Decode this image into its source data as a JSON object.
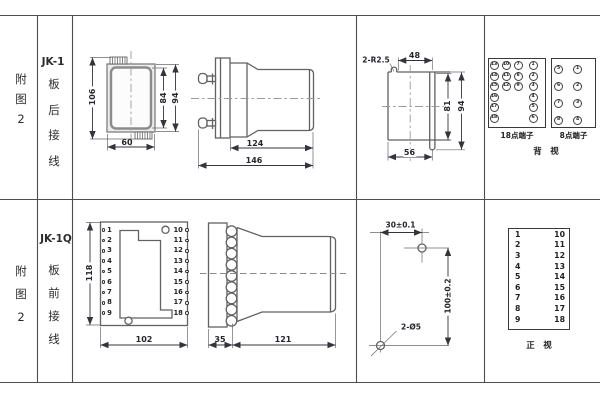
{
  "row1": {
    "fig_label": [
      "附",
      "图",
      "2"
    ],
    "model": "JK-1",
    "mount_label": [
      "板",
      "后",
      "接",
      "线"
    ],
    "rear": {
      "dim_total_h": "106",
      "dim_inner_h": "84",
      "dim_outer_h": "94",
      "dim_width": "60"
    },
    "side": {
      "dim_body": "124",
      "dim_total": "146"
    },
    "cutout": {
      "note_radius": "2-R2.5",
      "dim_top_w": "48",
      "dim_inner_h": "81",
      "dim_outer_h": "94",
      "dim_bottom_w": "56"
    },
    "t18": {
      "caption": "18点端子",
      "col1": [
        "13",
        "14",
        "15",
        "16",
        "17",
        "18"
      ],
      "col2": [
        "10",
        "11",
        "12"
      ],
      "col3": [
        "7",
        "8",
        "9"
      ],
      "col4": [
        "1",
        "2",
        "3",
        "4",
        "5",
        "6"
      ]
    },
    "t8": {
      "caption": "8点端子",
      "col1": [
        "5",
        "6",
        "7",
        "8"
      ],
      "col2": [
        "1",
        "2",
        "3",
        "4"
      ]
    },
    "view_label": "背　视"
  },
  "row2": {
    "fig_label": [
      "附",
      "图",
      "2"
    ],
    "model": "JK-1Q",
    "mount_label": [
      "板",
      "前",
      "接",
      "线"
    ],
    "front": {
      "dim_h": "118",
      "dim_w": "102",
      "left_terminals": [
        "1",
        "2",
        "3",
        "4",
        "5",
        "6",
        "7",
        "8",
        "9"
      ],
      "right_terminals": [
        "10",
        "11",
        "12",
        "13",
        "14",
        "15",
        "16",
        "17",
        "18"
      ]
    },
    "side": {
      "dim_panel": "35",
      "dim_body": "121"
    },
    "drill": {
      "dim_h": "30±0.1",
      "dim_v": "100±0.2",
      "note_holes": "2-Ø5"
    },
    "table": {
      "rows": [
        {
          "l": "1",
          "r": "10"
        },
        {
          "l": "2",
          "r": "11"
        },
        {
          "l": "3",
          "r": "12"
        },
        {
          "l": "4",
          "r": "13"
        },
        {
          "l": "5",
          "r": "14"
        },
        {
          "l": "6",
          "r": "15"
        },
        {
          "l": "7",
          "r": "16"
        },
        {
          "l": "8",
          "r": "17"
        },
        {
          "l": "9",
          "r": "18"
        }
      ]
    },
    "view_label": "正　视"
  }
}
